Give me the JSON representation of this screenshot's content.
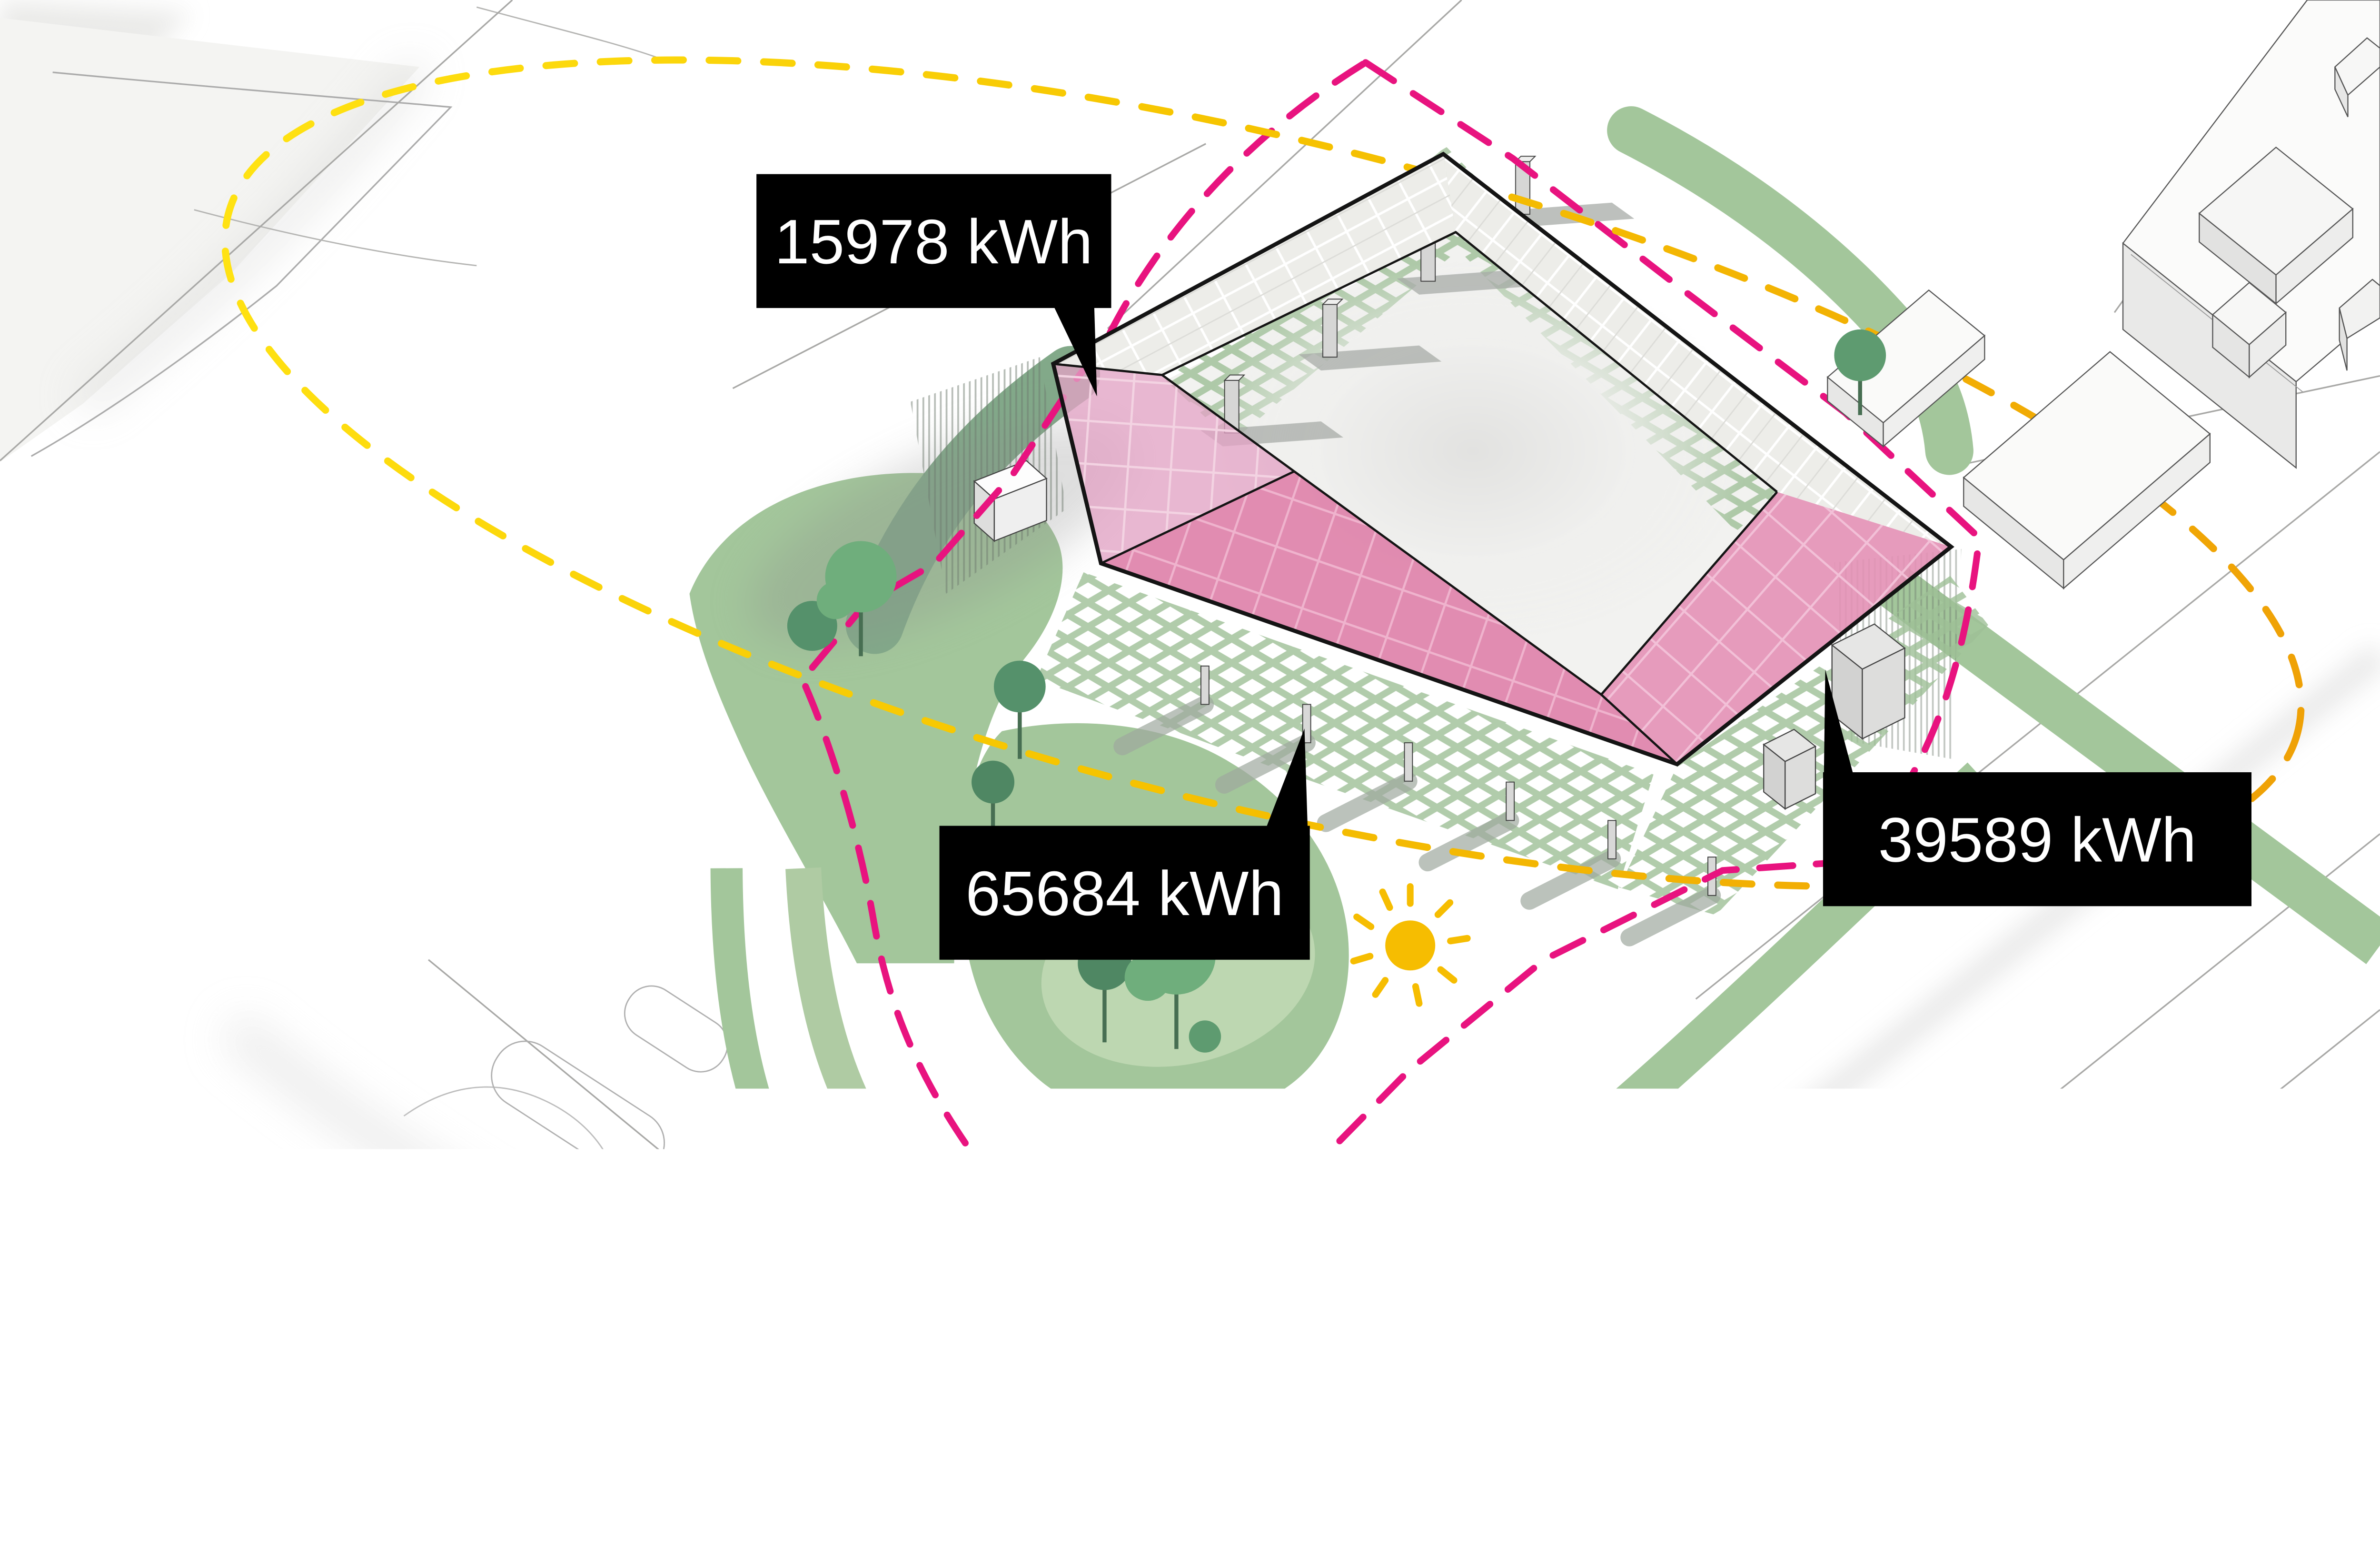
{
  "diagram": {
    "type": "site-plan-energy-scan",
    "callouts": {
      "left": {
        "label": "15978 kWh",
        "target": "left roof PV panel"
      },
      "front": {
        "label": "65684 kWh",
        "target": "front roof PV panel"
      },
      "right": {
        "label": "39589 kWh",
        "target": "right roof PV panel"
      }
    },
    "caption": {
      "lines": [
        "Quick scan of total",
        "annual energy",
        "generation potential",
        "based on PV cells",
        "integrated into glass"
      ]
    },
    "icons": {
      "sun": "sun-icon"
    },
    "colors": {
      "pv_pink_front": "#DE82AA",
      "pv_pink_light": "#E2A3C4",
      "pv_pink_right": "#E390B5",
      "site_boundary_magenta": "#E8137F",
      "solar_ring_yellow_left": "#FFE212",
      "solar_ring_yellow_right": "#EFA106",
      "sun_yellow": "#F6BD01",
      "landscape_green": "#A3C69B",
      "lattice_green": "#9DBF96",
      "tree_green_dark": "#4F8763",
      "tree_green_medium": "#6FAE7C",
      "callout_bg": "#000000",
      "callout_text": "#FFFFFF"
    }
  }
}
